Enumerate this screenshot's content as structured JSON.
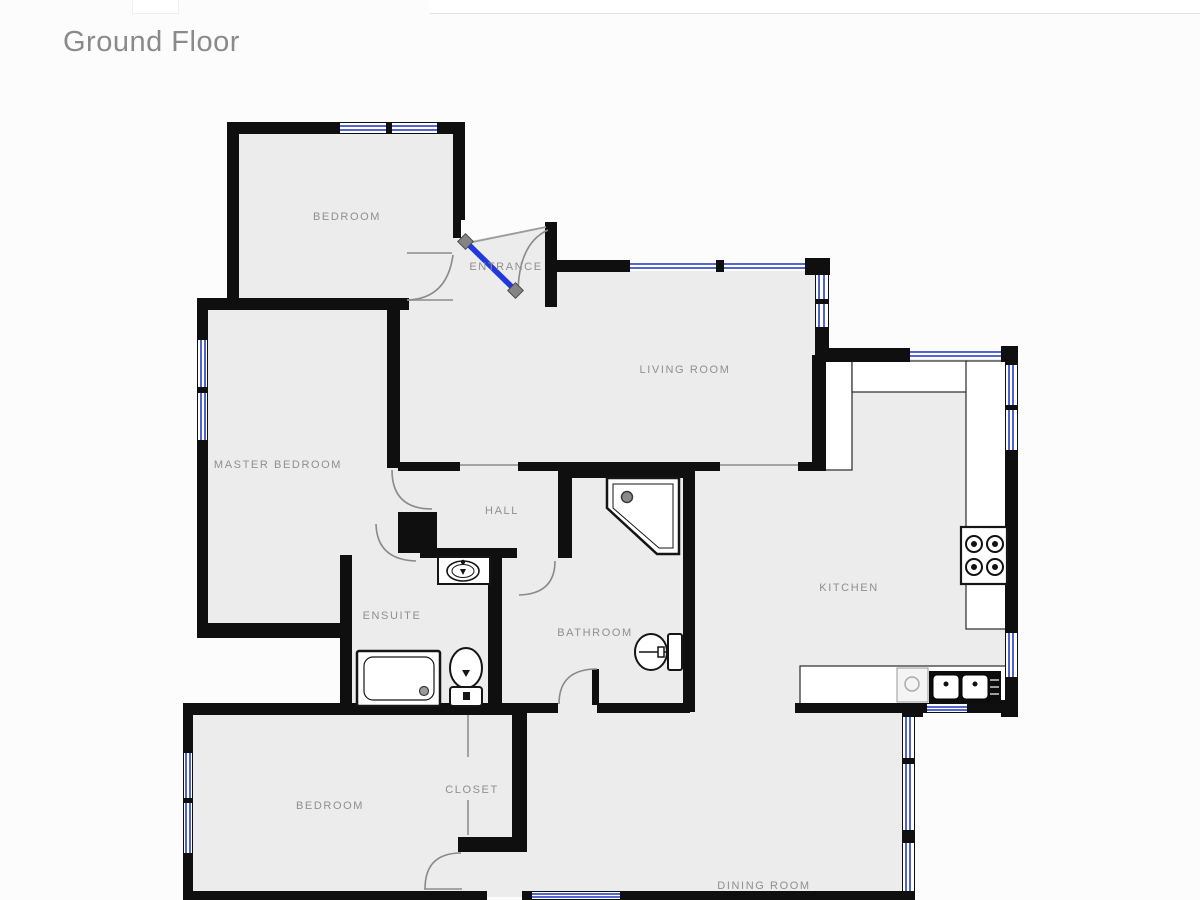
{
  "page": {
    "title": "Ground Floor"
  },
  "plan": {
    "rooms": [
      {
        "id": "bedroom-top",
        "label": "BEDROOM"
      },
      {
        "id": "entrance",
        "label": "ENTRANCE"
      },
      {
        "id": "living-room",
        "label": "LIVING ROOM"
      },
      {
        "id": "master-bedroom",
        "label": "MASTER BEDROOM"
      },
      {
        "id": "hall",
        "label": "HALL"
      },
      {
        "id": "ensuite",
        "label": "ENSUITE"
      },
      {
        "id": "bathroom",
        "label": "BATHROOM"
      },
      {
        "id": "kitchen",
        "label": "KITCHEN"
      },
      {
        "id": "bedroom-bottom",
        "label": "BEDROOM"
      },
      {
        "id": "closet",
        "label": "CLOSET"
      },
      {
        "id": "dining-room",
        "label": "DINING ROOM"
      }
    ],
    "colors": {
      "wall": "#0f0f0f",
      "floor": "#ececec",
      "window_line": "#3c50c8",
      "entry_door": "#2038dd",
      "label_text": "#8f8f8f"
    }
  }
}
